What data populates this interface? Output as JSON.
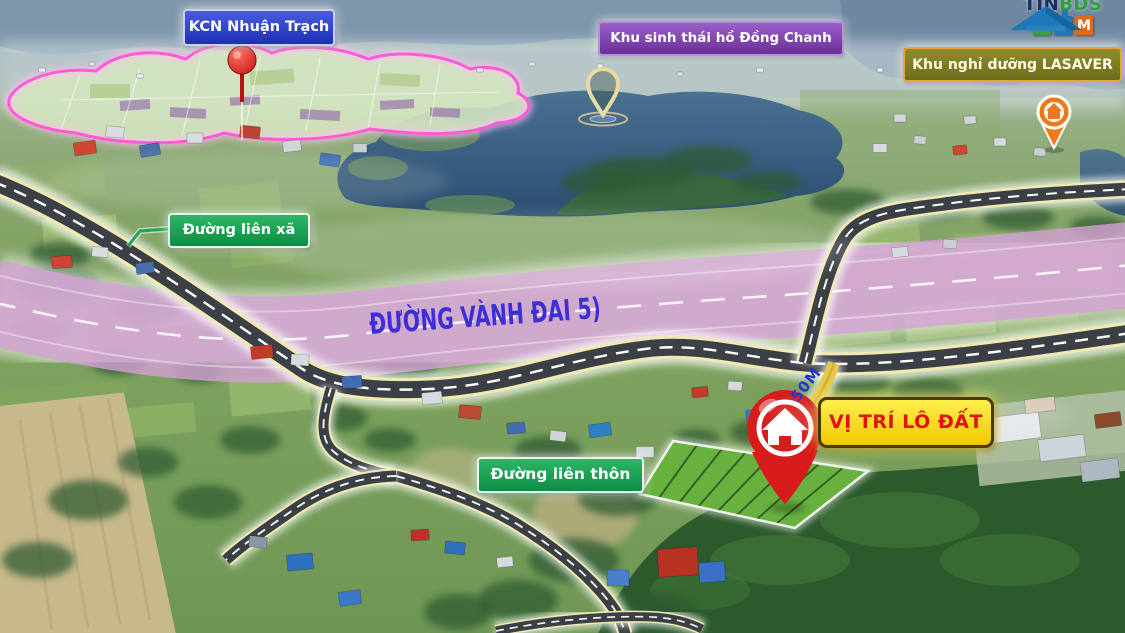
{
  "labels": {
    "industrial_zone": "KCN Nhuận Trạch",
    "eco_area": "Khu sinh thái hồ Đồng Chanh",
    "resort": "Khu nghỉ dưỡng LASAVER",
    "commune_road": "Đường liên xã",
    "ring_road": "ĐƯỜNG VÀNH ĐAI 5)",
    "village_road": "Đường liên thôn",
    "plot_location": "VỊ TRÍ LÔ ĐẤT",
    "frontage": "50M"
  },
  "branding": {
    "tin": "TIN",
    "bds": "BDS",
    "com_letters": [
      "C",
      "O",
      "M"
    ]
  },
  "colors": {
    "ring_road_band": "#d4a0d4",
    "ring_road_text": "#3d2ed8",
    "plot_fill": "#67b23e",
    "pin_red": "#d81c1c",
    "frontage_yellow": "#e8c84a",
    "frontage_text": "#2233d8",
    "outline_pink": "#ff5ad8",
    "label_green": "#16a254",
    "label_blue": "#2337c8",
    "label_purple": "#7a3da8",
    "label_olive": "#7f7c22",
    "label_yellow": "#ffdf1a",
    "plot_text_red": "#e01212",
    "road_dark": "#3b4046"
  }
}
